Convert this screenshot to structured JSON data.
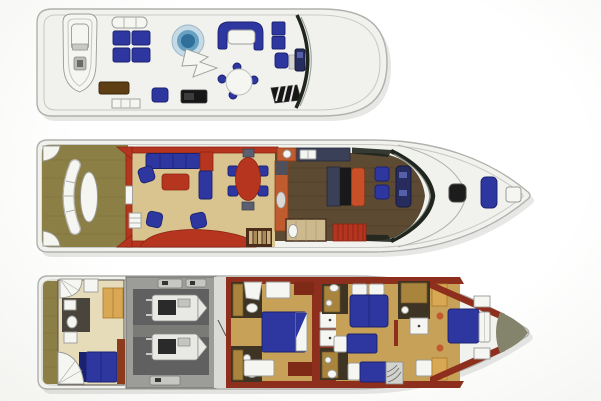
{
  "title": "three-deck-motor-yacht-floor-plan",
  "colors": {
    "page_bg": "#fcfcfa",
    "hull": "#f1f1ee",
    "hull_edge": "#b0b0ac",
    "inner_line": "#c9c9c5",
    "white_fixture": "#f5f5f2",
    "fixture_edge": "#9a9a96",
    "shadow": "#55554d",
    "teak": "#8c7f46",
    "teak_grain": "#6e6234",
    "royal_blue": "#2e36a0",
    "blue_edge": "#1a2270",
    "spa_rim": "#c6dae6",
    "spa_mid": "#66a0c2",
    "spa_deep": "#2f6f99",
    "red": "#b5351f",
    "red_edge": "#8c2414",
    "maroon": "#8e2f1d",
    "orange": "#bf5b2e",
    "orange_edge": "#8c3c16",
    "salon_floor": "#d9c48f",
    "wood_floor": "#5d4a33",
    "wood_grain": "#3e3122",
    "carpet_gold": "#c8a159",
    "crew_floor": "#e7dcba",
    "tan_cabinet": "#d8a855",
    "tan_edge": "#a87828",
    "counter_navy": "#3a4058",
    "counter_edge": "#23283c",
    "console_navy": "#272c5e",
    "console_edge": "#14173c",
    "screen_blue": "#5560a8",
    "tile_dark": "#3e3424",
    "tile_gold": "#a8843c",
    "tile_gold_edge": "#6e5524",
    "engine_wall": "#9c9c98",
    "engine_floor": "#606060",
    "machine_body": "#e8e8e4",
    "machine_edge": "#8a8a86",
    "machine_dark": "#2a2a2a",
    "glass_dark": "#20261e",
    "glass_tint": "#7a8278",
    "black": "#161616",
    "dark_brown": "#5e3e12",
    "stair_brown": "#4a2c18",
    "step_tan": "#c8b080",
    "step_tan_dark": "#a88b58",
    "redwood": "#7e2a16",
    "slate_chair": "#5a6070",
    "bow_shade": "#84846c",
    "burnt_bench": "#c94f28",
    "crew_floor_tone": "#e7dcba"
  },
  "decks": [
    {
      "id": "flybridge",
      "name": "flybridge-sun-deck",
      "features": [
        "tender-boat",
        "davit",
        "sun-pads",
        "wet-bar",
        "aft-steps",
        "spa-tub",
        "mast-arch",
        "lounge-settee",
        "settee-table",
        "grill",
        "crew-seat",
        "cocktail-table",
        "bench-seats",
        "helm-chair",
        "helm-console",
        "stairs-hatch",
        "venturi-windshield"
      ]
    },
    {
      "id": "main-deck",
      "name": "main-deck",
      "features": [
        "transom-steps",
        "aft-bench",
        "aft-table",
        "teak-cockpit",
        "salon-sofa",
        "corner-cabinet",
        "coffee-table",
        "armchairs",
        "dining-table",
        "dining-chairs",
        "salon-stairs",
        "galley-counters",
        "galley-island",
        "day-head",
        "companionway-stairs",
        "helm-chairs",
        "pilothouse-console",
        "windshield",
        "foredeck-hatch",
        "foredeck-sun-pad",
        "anchor-locker"
      ]
    },
    {
      "id": "lower-deck",
      "name": "lower-deck",
      "features": [
        "swim-platform",
        "spiral-stairs",
        "crew-cabin",
        "crew-head",
        "crew-berth",
        "engine-room",
        "port-engine",
        "starboard-engine",
        "master-stateroom",
        "master-berth",
        "his-bath",
        "hers-bath",
        "master-dressers",
        "guest-bath-aft",
        "guest-bath-fwd",
        "guest-double-berth",
        "twin-berths",
        "mid-stairs",
        "shower-stall",
        "vip-stateroom",
        "vip-berth",
        "chain-locker"
      ]
    }
  ]
}
